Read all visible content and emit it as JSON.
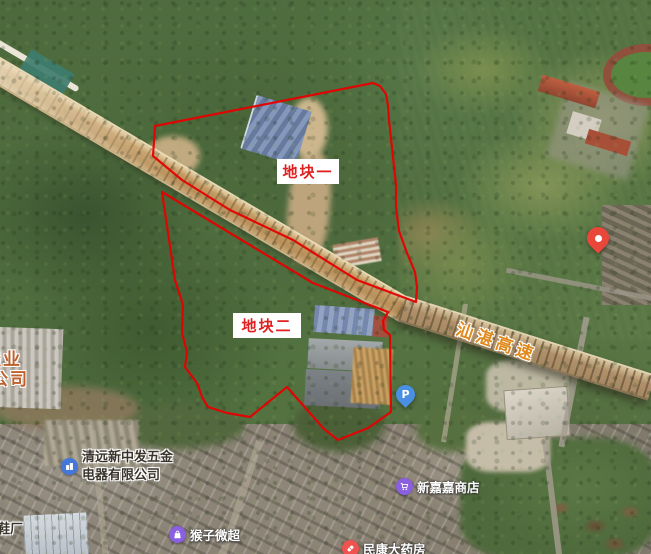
{
  "colors": {
    "plot_stroke": "#e60000",
    "plot_label_text": "#e02020",
    "highway_label": "#e0891a",
    "edge_label": "#bf5f2a",
    "icon_blue": "#4377d9",
    "icon_purple": "#8a5fe0",
    "icon_red": "#ef5350",
    "parking_blue": "#4a90e2",
    "pin_red": "#e8473a"
  },
  "plots": {
    "plot1": {
      "label": "地块一",
      "label_box": {
        "x": 277,
        "y": 159,
        "w": 62,
        "h": 25
      },
      "points": [
        [
          155,
          126
        ],
        [
          373,
          83
        ],
        [
          380,
          86
        ],
        [
          386,
          94
        ],
        [
          388,
          106
        ],
        [
          389,
          120
        ],
        [
          393,
          157
        ],
        [
          396,
          185
        ],
        [
          396,
          207
        ],
        [
          399,
          231
        ],
        [
          407,
          253
        ],
        [
          415,
          272
        ],
        [
          417,
          287
        ],
        [
          416,
          302
        ],
        [
          357,
          280
        ],
        [
          293,
          240
        ],
        [
          230,
          210
        ],
        [
          182,
          180
        ],
        [
          153,
          156
        ]
      ]
    },
    "plot2": {
      "label": "地块二",
      "label_box": {
        "x": 233,
        "y": 313,
        "w": 68,
        "h": 25
      },
      "points": [
        [
          162,
          192
        ],
        [
          240,
          239
        ],
        [
          313,
          283
        ],
        [
          388,
          312
        ],
        [
          383,
          321
        ],
        [
          384,
          330
        ],
        [
          390,
          335
        ],
        [
          391,
          412
        ],
        [
          368,
          428
        ],
        [
          338,
          440
        ],
        [
          329,
          433
        ],
        [
          323,
          428
        ],
        [
          287,
          387
        ],
        [
          250,
          417
        ],
        [
          227,
          413
        ],
        [
          208,
          407
        ],
        [
          202,
          397
        ],
        [
          197,
          383
        ],
        [
          185,
          367
        ],
        [
          187,
          352
        ],
        [
          182,
          333
        ],
        [
          183,
          305
        ],
        [
          175,
          280
        ]
      ]
    }
  },
  "highway": {
    "label": "汕湛高速",
    "pos": {
      "x": 455,
      "y": 328
    }
  },
  "edge_label": {
    "line1": "佳业",
    "line2": "公司",
    "pos": {
      "x": -9,
      "y": 350
    }
  },
  "pois": {
    "hardware": {
      "line1": "清远新中发五金",
      "line2": "电器有限公司",
      "pos": {
        "x": 61,
        "y": 449
      }
    },
    "shoe": {
      "label": "鞋厂",
      "pos": {
        "x": -3,
        "y": 521
      }
    },
    "monkey": {
      "label": "猴子微超",
      "pos": {
        "x": 169,
        "y": 525
      }
    },
    "xinjiajia": {
      "label": "新嘉嘉商店",
      "pos": {
        "x": 396,
        "y": 477
      }
    },
    "minkang": {
      "label": "民康大药房",
      "pos": {
        "x": 342,
        "y": 539
      }
    }
  },
  "markers": {
    "parking": {
      "letter": "P",
      "pos": {
        "x": 396,
        "y": 385
      }
    },
    "destination": {
      "pos": {
        "x": 587,
        "y": 227
      }
    }
  }
}
